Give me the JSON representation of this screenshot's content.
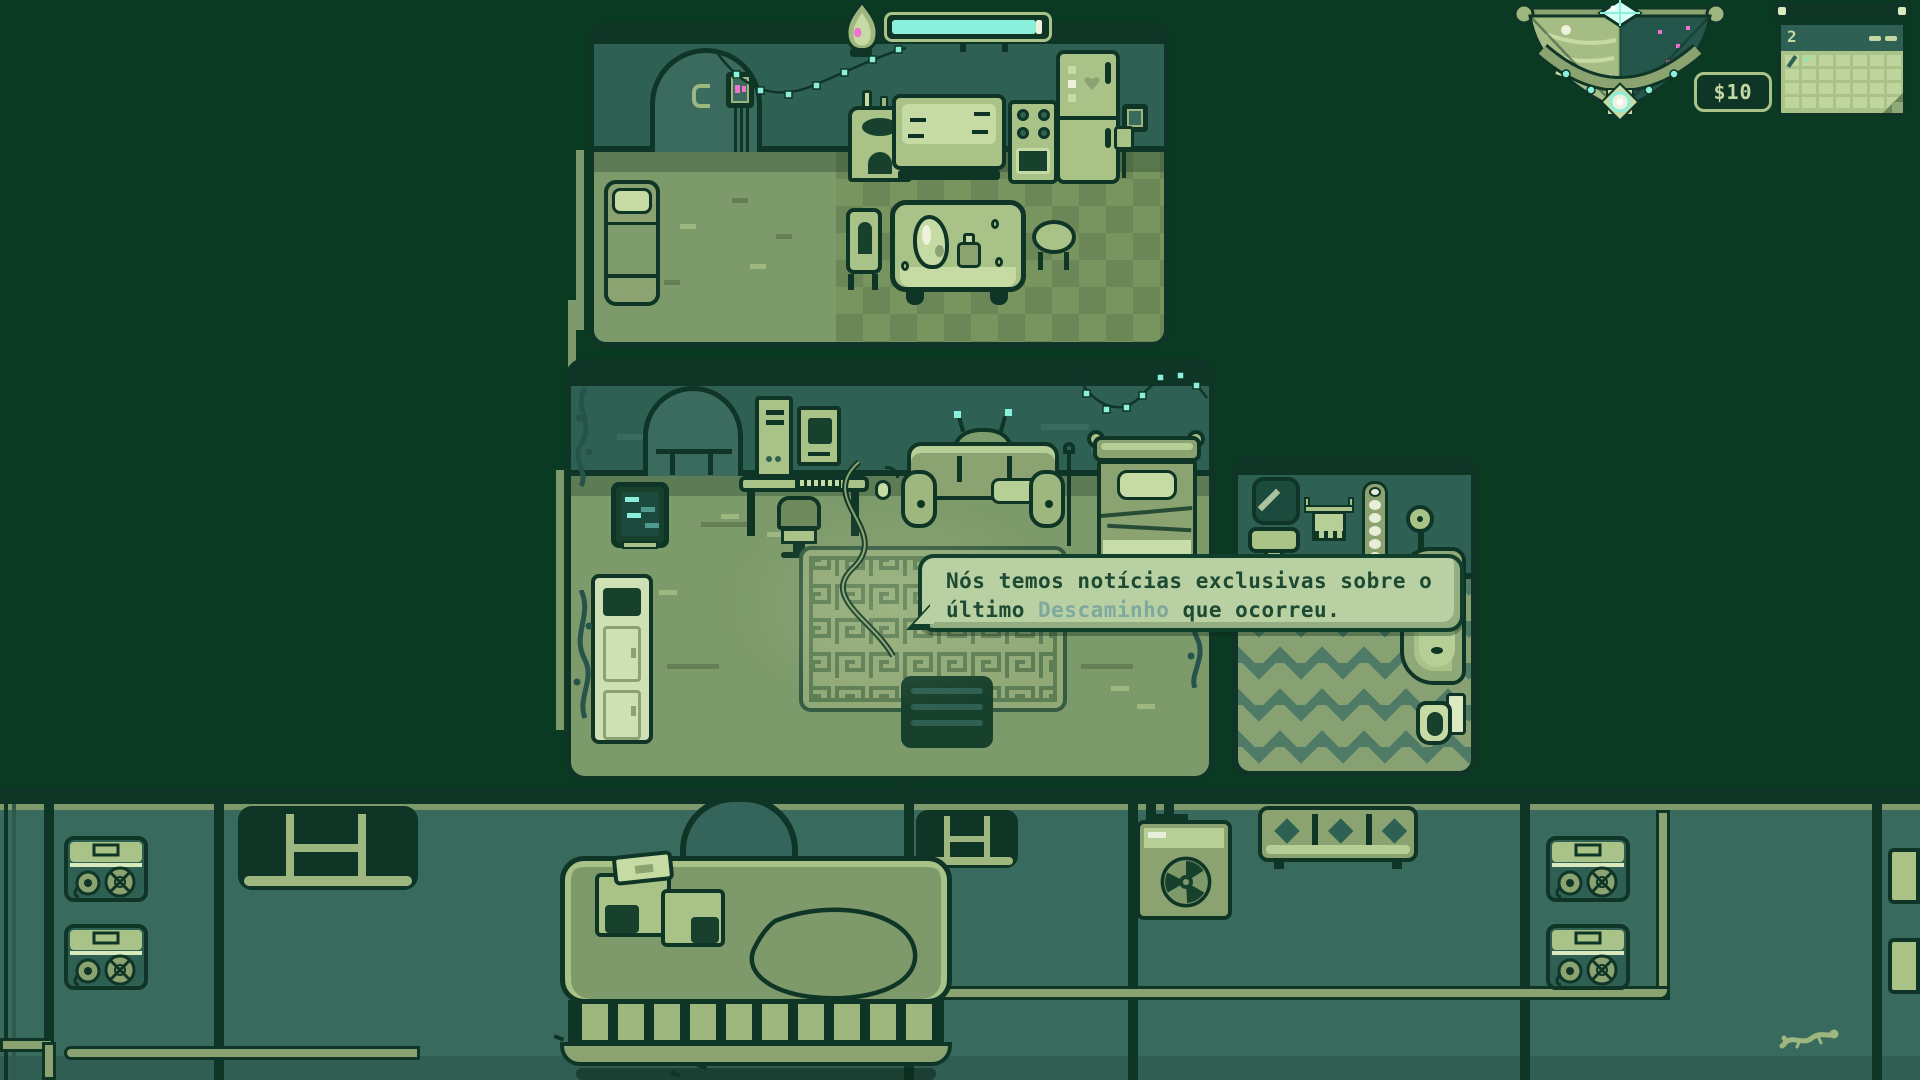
{
  "hud": {
    "flame_meter": {
      "icon": "flame-icon",
      "progress_pct": 95,
      "fill_style": "width:95%"
    },
    "money": {
      "label": "$10"
    },
    "calendar": {
      "day": "2",
      "check_glyph": "✓"
    }
  },
  "dialogue": {
    "line1": "Nós temos notícias exclusivas sobre o",
    "line2_before": "último ",
    "keyword": "Descaminho",
    "line2_after": " que ocorreu."
  },
  "icons": {
    "flame": "flame-icon",
    "day_night_dial": "day-night-dial-icon",
    "gem": "gem-icon",
    "sunburst": "sunburst-icon",
    "calendar_check": "check-icon",
    "radiation": "radiation-icon"
  },
  "palette": {
    "background": "#0b3a23",
    "wall": "#2f6054",
    "floor": "#7d9a6a",
    "accent_cyan": "#8af0dc",
    "accent_pink": "#ef72d0",
    "dialog_bg": "#b9d0a2",
    "dialog_text": "#1d4a33",
    "keyword_text": "#7fa89f"
  }
}
